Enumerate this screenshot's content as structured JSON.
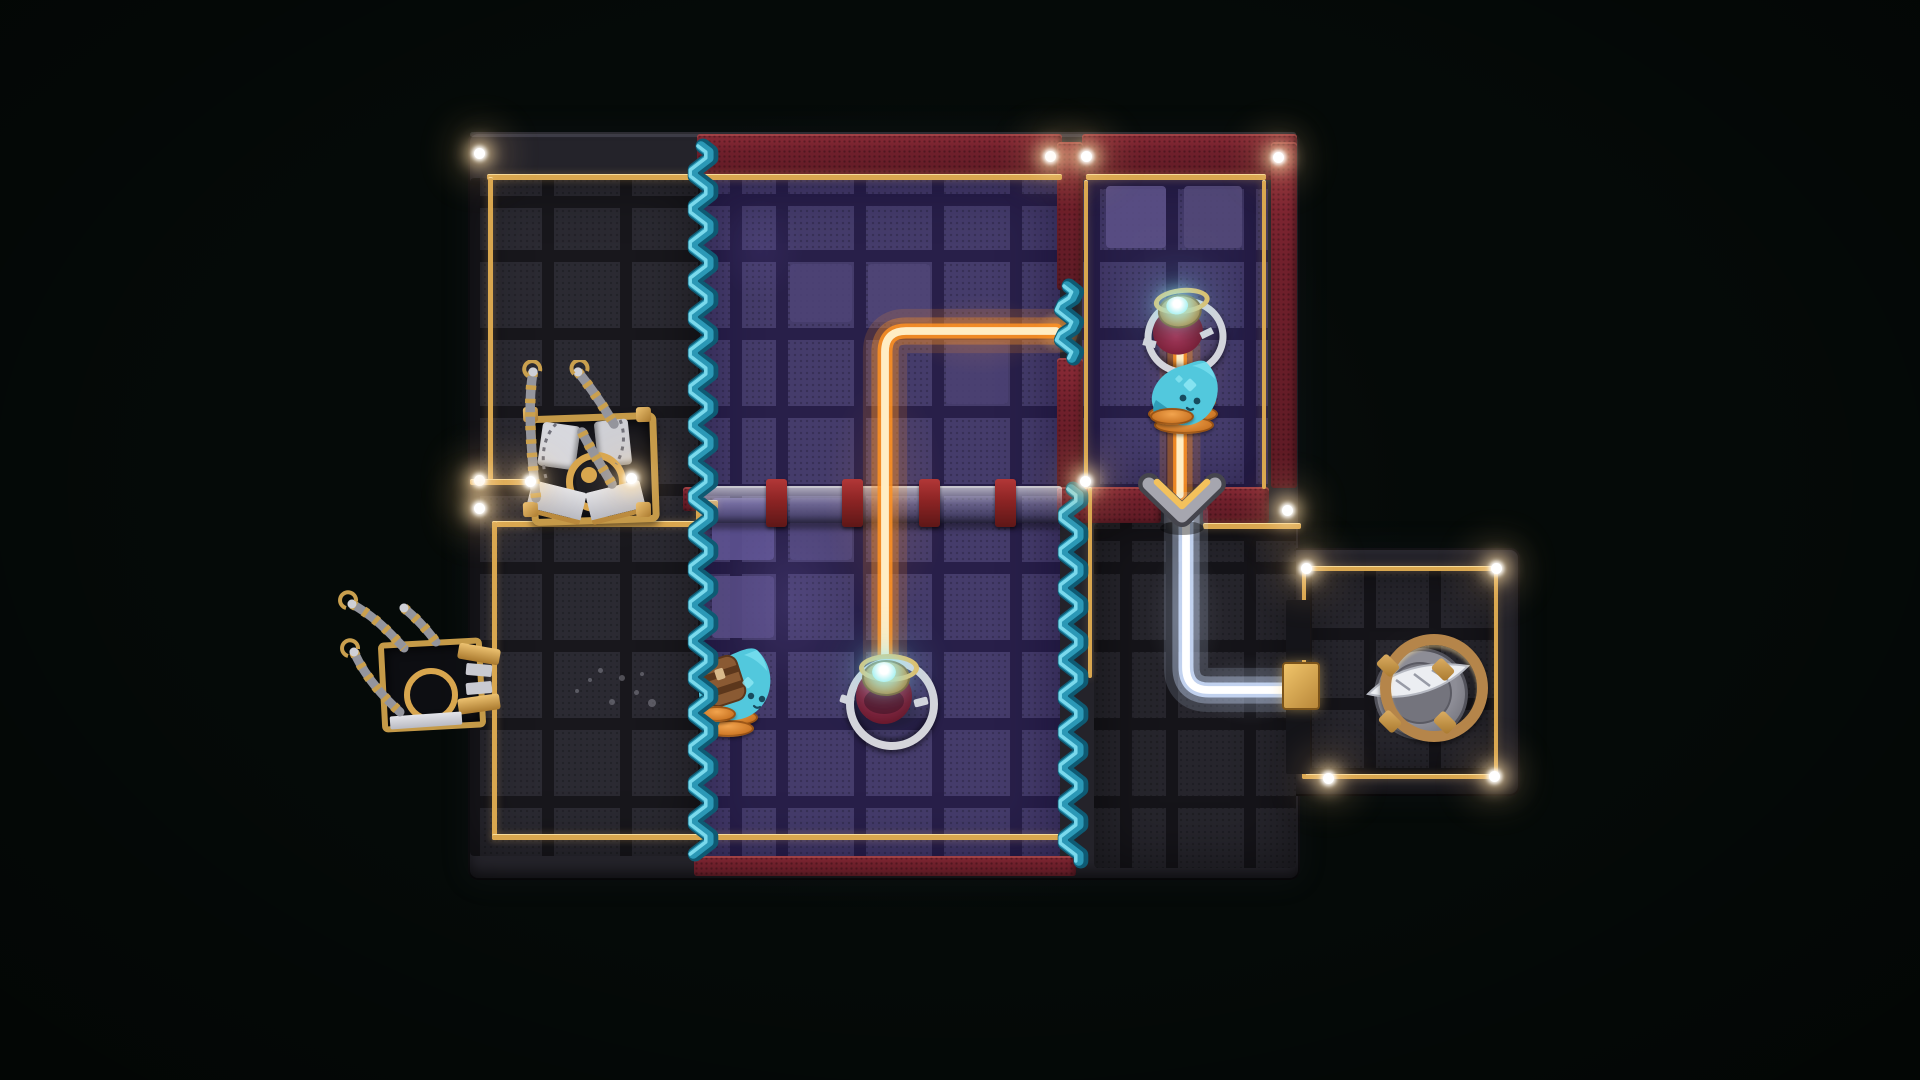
{
  "scene": {
    "background": "#050a08",
    "width": 1920,
    "height": 1080
  },
  "palette": {
    "board": "#24232a",
    "tile_dark_gap": "#17161b",
    "purple_tile": "#453c6b",
    "purple_gap": "#281f49",
    "red_wall": "#73212e",
    "red_wall_bright": "#93303c",
    "gold_trim": "#d9a74f",
    "gold_bright": "#f2cd82",
    "beam_orange": "#ff9222",
    "beam_orange_core": "#ffedc4",
    "beam_white": "#cfe0ff",
    "beam_white_core": "#ffffff",
    "curtain_dark": "#0e5a73",
    "curtain_mid": "#2b98b6",
    "curtain_light": "#7ad9ec",
    "blob_body": "#52c8dd",
    "blob_shade": "#2f9db8",
    "spring_orange": "#e08a36",
    "pedestal_red": "#8e1f3e",
    "silver": "#d5d5db",
    "gem_cyan": "#bdf6f6",
    "light_halo": "#ffd9a0"
  },
  "regions": [
    {
      "name": "room-top-left-floor",
      "x": 470,
      "y": 178,
      "w": 230,
      "h": 678,
      "base": "#2b2a32",
      "gap": "#18171c",
      "cellW": 78,
      "cellH": 78,
      "offX": 72,
      "offY": 72,
      "inset": "rgba(0,0,0,0.5)"
    },
    {
      "name": "room-purple-floor",
      "x": 702,
      "y": 178,
      "w": 358,
      "h": 680,
      "base": "#453c6b",
      "gap": "#281f49",
      "cellW": 78,
      "cellH": 78,
      "offX": 74,
      "offY": 72,
      "inset": "rgba(12,5,40,0.55)"
    },
    {
      "name": "room-top-right-floor",
      "x": 1082,
      "y": 180,
      "w": 186,
      "h": 307,
      "base": "#463d6d",
      "gap": "#281f49",
      "cellW": 78,
      "cellH": 78,
      "offX": 6,
      "offY": 70,
      "inset": "rgba(12,5,40,0.5)"
    },
    {
      "name": "room-bottom-right-floor",
      "x": 1094,
      "y": 523,
      "w": 202,
      "h": 345,
      "base": "#26252c",
      "gap": "#151419",
      "cellW": 78,
      "cellH": 78,
      "offX": 72,
      "offY": 39,
      "inset": "rgba(0,0,0,0.5)"
    },
    {
      "name": "annex-room-floor",
      "x": 1304,
      "y": 566,
      "w": 194,
      "h": 210,
      "base": "#27262d",
      "gap": "#151419",
      "cellW": 65,
      "cellH": 70,
      "offX": 60,
      "offY": 62,
      "inset": "rgba(0,0,0,0.5)"
    }
  ],
  "bright_tiles": [
    {
      "x": 1106,
      "y": 186,
      "w": 60,
      "h": 62,
      "c": "#5a4f85"
    },
    {
      "x": 1184,
      "y": 186,
      "w": 58,
      "h": 62,
      "c": "#524878"
    },
    {
      "x": 712,
      "y": 498,
      "w": 62,
      "h": 62,
      "c": "#5d5290"
    },
    {
      "x": 712,
      "y": 576,
      "w": 62,
      "h": 62,
      "c": "#554a82"
    },
    {
      "x": 790,
      "y": 498,
      "w": 62,
      "h": 62,
      "c": "#50467b"
    },
    {
      "x": 868,
      "y": 264,
      "w": 62,
      "h": 58,
      "c": "#4f4577"
    },
    {
      "x": 946,
      "y": 342,
      "w": 62,
      "h": 62,
      "c": "#4a4072"
    },
    {
      "x": 790,
      "y": 264,
      "w": 62,
      "h": 58,
      "c": "#4d4376"
    }
  ],
  "floor_patches": [
    {
      "x": 700,
      "y": 470,
      "w": 180,
      "h": 260,
      "c": "rgba(150,130,230,0.14)"
    },
    {
      "x": 800,
      "y": 330,
      "w": 170,
      "h": 340,
      "c": "rgba(255,150,70,0.10)"
    },
    {
      "x": 880,
      "y": 280,
      "w": 200,
      "h": 110,
      "c": "rgba(255,160,80,0.12)"
    },
    {
      "x": 1026,
      "y": 301,
      "w": 64,
      "h": 62,
      "c": "rgba(255,210,140,0.55)"
    },
    {
      "x": 1120,
      "y": 250,
      "w": 130,
      "h": 200,
      "c": "rgba(255,150,80,0.10)"
    },
    {
      "x": 1156,
      "y": 490,
      "w": 60,
      "h": 60,
      "c": "rgba(255,240,200,0.35)"
    },
    {
      "x": 1130,
      "y": 520,
      "w": 110,
      "h": 190,
      "c": "rgba(210,225,255,0.10)"
    },
    {
      "x": 1180,
      "y": 640,
      "w": 140,
      "h": 100,
      "c": "rgba(210,225,255,0.10)"
    },
    {
      "x": 540,
      "y": 380,
      "w": 160,
      "h": 200,
      "c": "rgba(255,255,255,0.035)"
    },
    {
      "x": 700,
      "y": 180,
      "w": 120,
      "h": 140,
      "c": "rgba(120,100,200,0.10)"
    },
    {
      "x": 1340,
      "y": 600,
      "w": 160,
      "h": 160,
      "c": "rgba(255,255,255,0.03)"
    }
  ],
  "red_walls": [
    {
      "name": "top-wall-left",
      "x": 697,
      "y": 134,
      "w": 365,
      "h": 46
    },
    {
      "name": "top-wall-right",
      "x": 1082,
      "y": 134,
      "w": 215,
      "h": 46
    },
    {
      "name": "divider-wall-upper",
      "x": 1057,
      "y": 142,
      "w": 26,
      "h": 148
    },
    {
      "name": "divider-wall-lower",
      "x": 1057,
      "y": 358,
      "w": 26,
      "h": 130
    },
    {
      "name": "right-wall",
      "x": 1271,
      "y": 142,
      "w": 26,
      "h": 346
    },
    {
      "name": "tr-room-bottom-left",
      "x": 1057,
      "y": 487,
      "w": 104,
      "h": 36
    },
    {
      "name": "tr-room-bottom-right",
      "x": 1203,
      "y": 487,
      "w": 66,
      "h": 36
    },
    {
      "name": "purple-bottom-wall",
      "x": 694,
      "y": 856,
      "w": 382,
      "h": 20
    },
    {
      "name": "bridge-left-cap",
      "x": 683,
      "y": 487,
      "w": 16,
      "h": 24
    }
  ],
  "trim": [
    [
      487,
      174,
      575,
      5
    ],
    [
      1086,
      174,
      180,
      5
    ],
    [
      488,
      177,
      5,
      302
    ],
    [
      470,
      479,
      64,
      5
    ],
    [
      492,
      521,
      210,
      5
    ],
    [
      492,
      521,
      5,
      318
    ],
    [
      492,
      834,
      570,
      5
    ],
    [
      1084,
      180,
      4,
      308
    ],
    [
      1262,
      180,
      4,
      308
    ],
    [
      1203,
      523,
      98,
      5
    ],
    [
      1088,
      487,
      4,
      190
    ],
    [
      1302,
      566,
      196,
      4
    ],
    [
      1302,
      774,
      196,
      4
    ],
    [
      1302,
      566,
      4,
      104
    ],
    [
      1302,
      700,
      4,
      78
    ],
    [
      1494,
      566,
      4,
      212
    ],
    [
      696,
      500,
      22,
      8
    ],
    [
      696,
      500,
      8,
      32
    ]
  ],
  "bridge": {
    "rail": {
      "x": 700,
      "y": 486,
      "w": 362,
      "h": 35
    },
    "clampXs": [
      766,
      842,
      919,
      995
    ],
    "clampY": 479,
    "clampW": 21,
    "clampH": 48
  },
  "beams": [
    {
      "name": "beam-orange-main",
      "path": "M 885 666 L 885 352 Q 885 331 906 331 L 1056 331",
      "color": "#ff9222",
      "core": "#ffedc4",
      "width": 13
    },
    {
      "name": "beam-orange-upper",
      "path": "M 1180 346 L 1180 495",
      "color": "#ff9222",
      "core": "#ffedc4",
      "width": 12
    },
    {
      "name": "beam-white",
      "path": "M 1186 514 L 1186 667 Q 1186 690 1209 690 L 1296 690",
      "color": "#cfe0ff",
      "core": "#ffffff",
      "width": 13
    }
  ],
  "curtains": [
    {
      "name": "curtain-left",
      "x": 703,
      "y1": 146,
      "y2": 858,
      "amp": 9,
      "period": 36
    },
    {
      "name": "curtain-right",
      "x": 1073,
      "y1": 489,
      "y2": 866,
      "amp": 9,
      "period": 36
    },
    {
      "name": "curtain-gap-piece",
      "x": 1069,
      "y1": 286,
      "y2": 362,
      "amp": 8,
      "period": 30
    }
  ],
  "lights": [
    [
      479,
      153
    ],
    [
      1050,
      156
    ],
    [
      1086,
      156
    ],
    [
      1278,
      157
    ],
    [
      479,
      480
    ],
    [
      479,
      508
    ],
    [
      530,
      481
    ],
    [
      631,
      478
    ],
    [
      1085,
      481
    ],
    [
      1287,
      510
    ],
    [
      1306,
      568
    ],
    [
      1496,
      568
    ],
    [
      1328,
      778
    ],
    [
      1494,
      776
    ]
  ],
  "speckles": [
    [
      652,
      703,
      4
    ],
    [
      622,
      678,
      3
    ],
    [
      600,
      670,
      2.5
    ],
    [
      636,
      692,
      2.5
    ],
    [
      577,
      691,
      2
    ],
    [
      612,
      702,
      3
    ],
    [
      642,
      674,
      2
    ],
    [
      590,
      680,
      2
    ]
  ]
}
